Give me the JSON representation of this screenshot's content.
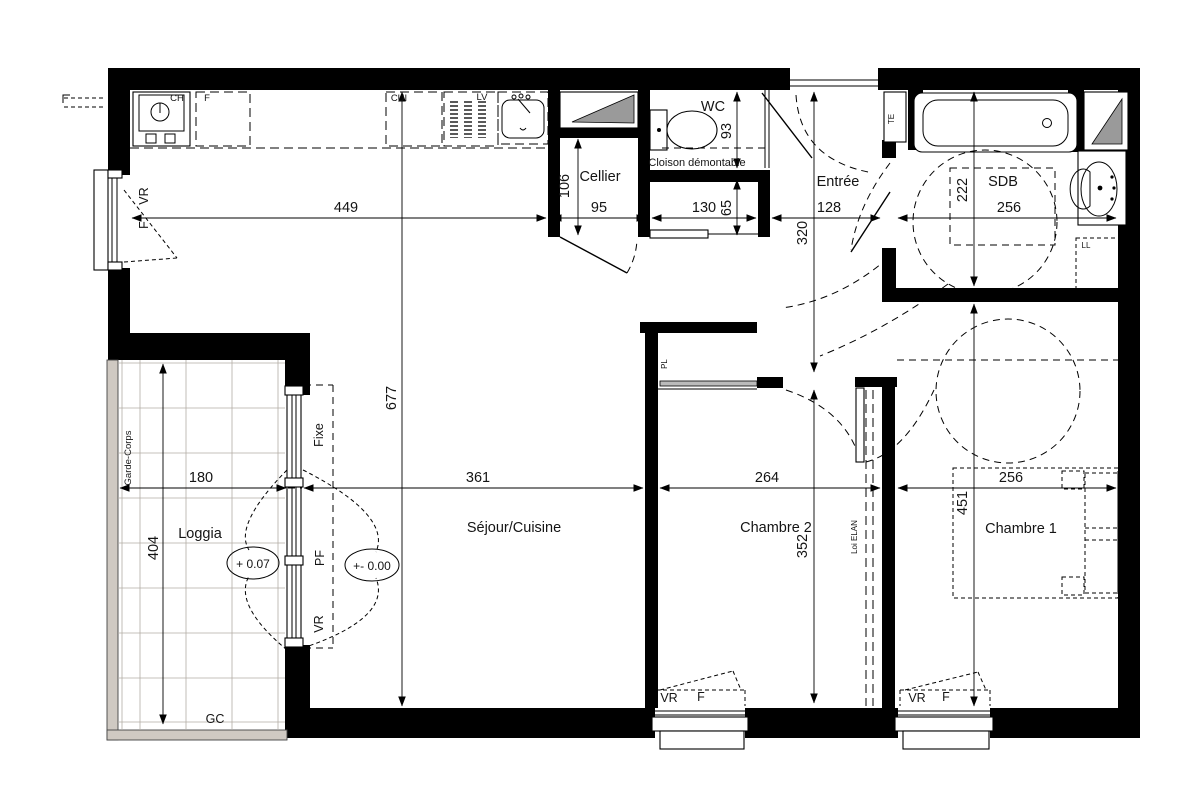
{
  "plan_title": "Plan d'appartement T3",
  "rooms": {
    "loggia": "Loggia",
    "sejour": "Séjour/Cuisine",
    "cellier": "Cellier",
    "wc": "WC",
    "entree": "Entrée",
    "sdb": "SDB",
    "chambre2": "Chambre 2",
    "chambre1": "Chambre 1"
  },
  "dims": {
    "kitchen_width": "449",
    "cellier_width": "95",
    "cellier_depth": "106",
    "niche_width": "130",
    "niche_height": "65",
    "wc_depth": "93",
    "entree_width": "128",
    "entree_depth": "320",
    "sdb_width": "256",
    "sdb_depth": "222",
    "sejour_height": "677",
    "sejour_width": "361",
    "chambre2_width": "264",
    "chambre2_depth": "352",
    "chambre1_width": "256",
    "chambre1_depth": "451",
    "loggia_width": "180",
    "loggia_depth": "404"
  },
  "labels": {
    "cloison": "Cloison démontable",
    "garde_corps": "Garde-Corps",
    "gc": "GC",
    "loi_elan": "Loi ELAN",
    "fixe": "Fixe",
    "pf": "PF",
    "vr": "VR",
    "f": "F",
    "te": "TE",
    "ll": "LL",
    "ch": "CH",
    "cui": "CUI",
    "lv": "LV",
    "pl": "PL",
    "level_loggia": "+ 0.07",
    "level_sejour": "+- 0.00"
  },
  "colors": {
    "wall": "#000000",
    "shaft_gray": "#9a9a9a",
    "garde_corps_fill": "#cfc9c2",
    "paper": "#ffffff"
  }
}
